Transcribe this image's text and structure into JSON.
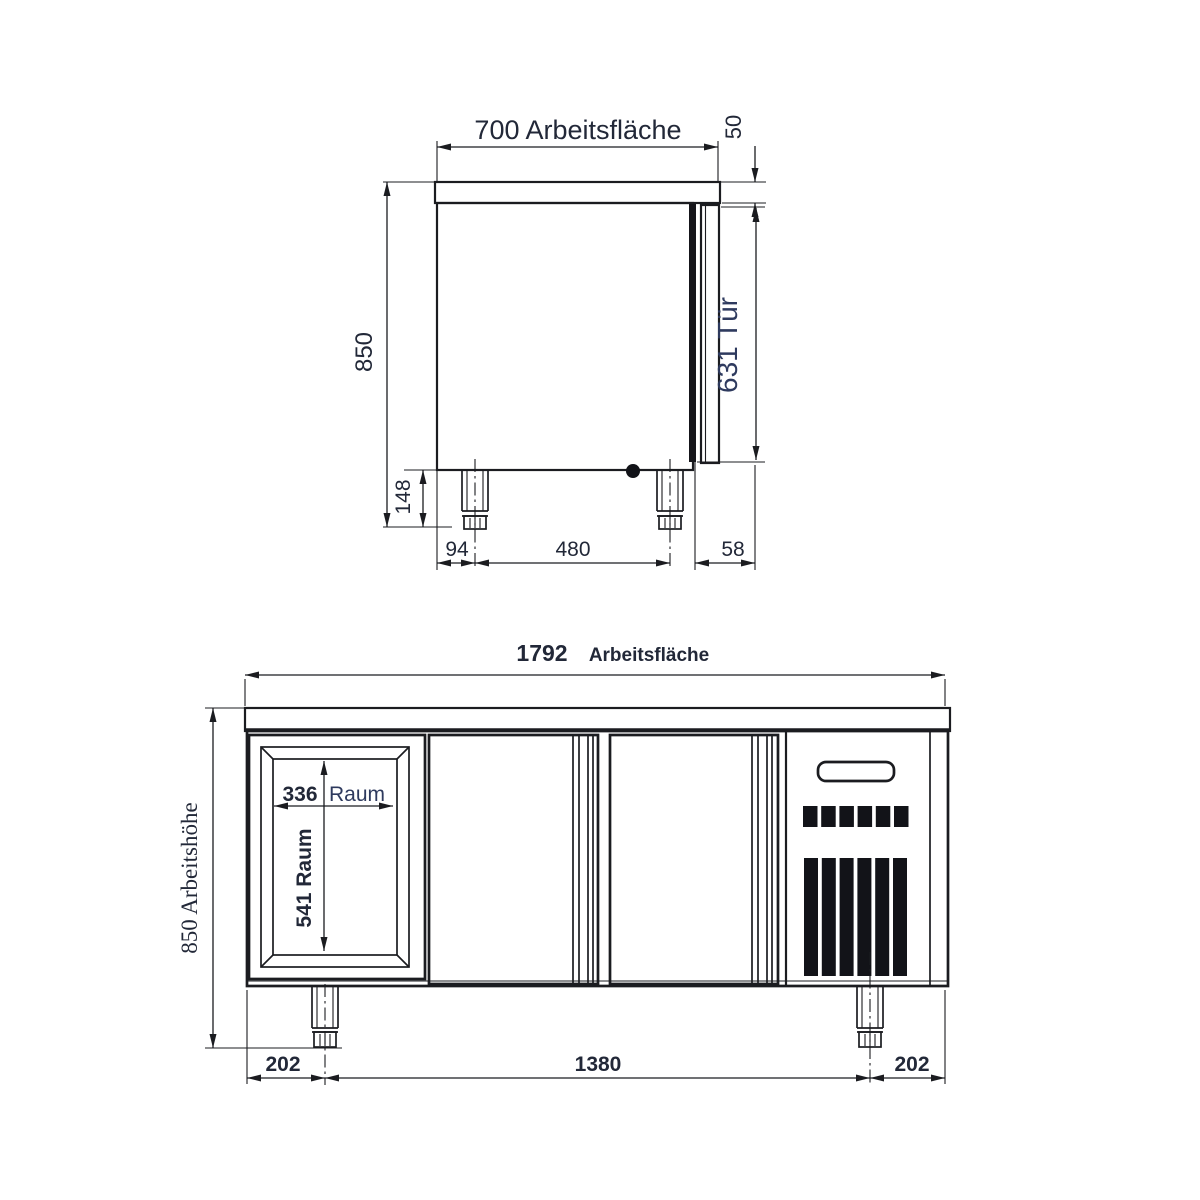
{
  "side_view": {
    "worktop_dim": "700 Arbeitsfläche",
    "worktop_thickness_dim": "50",
    "overall_height_dim": "850",
    "door_dim": "631 Tür",
    "leg_height_dim": "148",
    "back_offset_dim": "94",
    "leg_spacing_dim": "480",
    "door_depth_dim": "58"
  },
  "front_view": {
    "worktop_width_value": "1792",
    "worktop_width_label": "Arbeitsfläche",
    "work_height_dim": "850 Arbeitshöhe",
    "compartment_width_value": "336",
    "compartment_width_label": "Raum",
    "compartment_height_dim": "541 Raum",
    "left_leg_offset_dim": "202",
    "leg_spacing_dim": "1380",
    "right_leg_offset_dim": "202",
    "vent": {
      "square_count": 6,
      "bar_count": 6
    }
  },
  "colors": {
    "line": "#1b1c20",
    "text": "#222838",
    "accent_text": "#2e3a5e",
    "fill_dark": "#121318"
  }
}
